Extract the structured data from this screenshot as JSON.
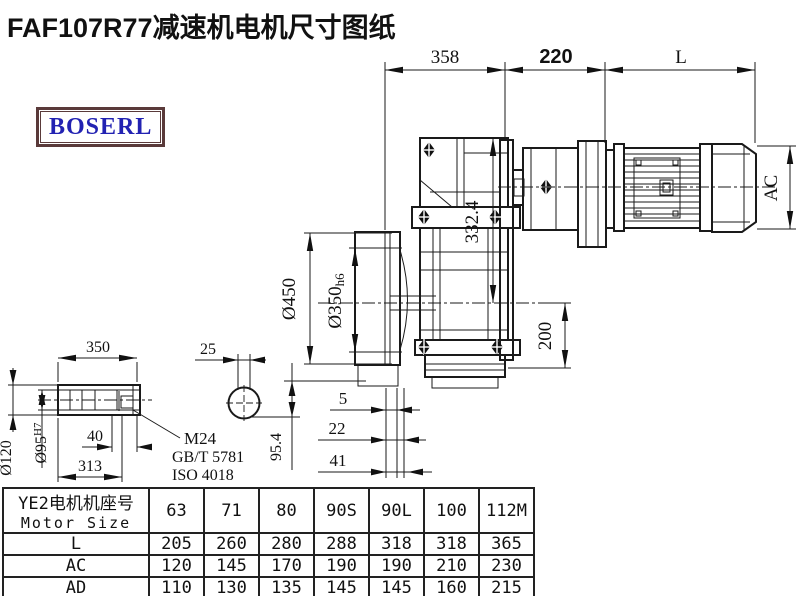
{
  "title": "FAF107R77减速机电机尺寸图纸",
  "logo": {
    "text": "BOSERL",
    "border_color": "#5a3a3a",
    "text_color": "#2222b2"
  },
  "drawing": {
    "dims": {
      "len358": "358",
      "len220": "220",
      "lenL": "L",
      "ac": "AC",
      "h332": "332.4",
      "dia450": "Ø450",
      "dia350": "Ø350",
      "dia350tol": "h6",
      "h200": "200",
      "g5": "5",
      "g22": "22",
      "g41": "41",
      "h954": "95.4",
      "d25": "25",
      "l350": "350",
      "d120": "Ø120",
      "d95": "Ø95",
      "d95tol": "H7",
      "l40": "40",
      "l313": "313",
      "bolt": "M24",
      "std1": "GB/T 5781",
      "std2": "ISO 4018"
    }
  },
  "table": {
    "header_cn": "YE2电机机座号",
    "header_en": "Motor Size",
    "columns": [
      "63",
      "71",
      "80",
      "90S",
      "90L",
      "100",
      "112M"
    ],
    "rows": [
      {
        "label": "L",
        "values": [
          "205",
          "260",
          "280",
          "288",
          "318",
          "318",
          "365"
        ]
      },
      {
        "label": "AC",
        "values": [
          "120",
          "145",
          "170",
          "190",
          "190",
          "210",
          "230"
        ]
      },
      {
        "label": "AD",
        "values": [
          "110",
          "130",
          "135",
          "145",
          "145",
          "160",
          "215"
        ]
      }
    ]
  }
}
